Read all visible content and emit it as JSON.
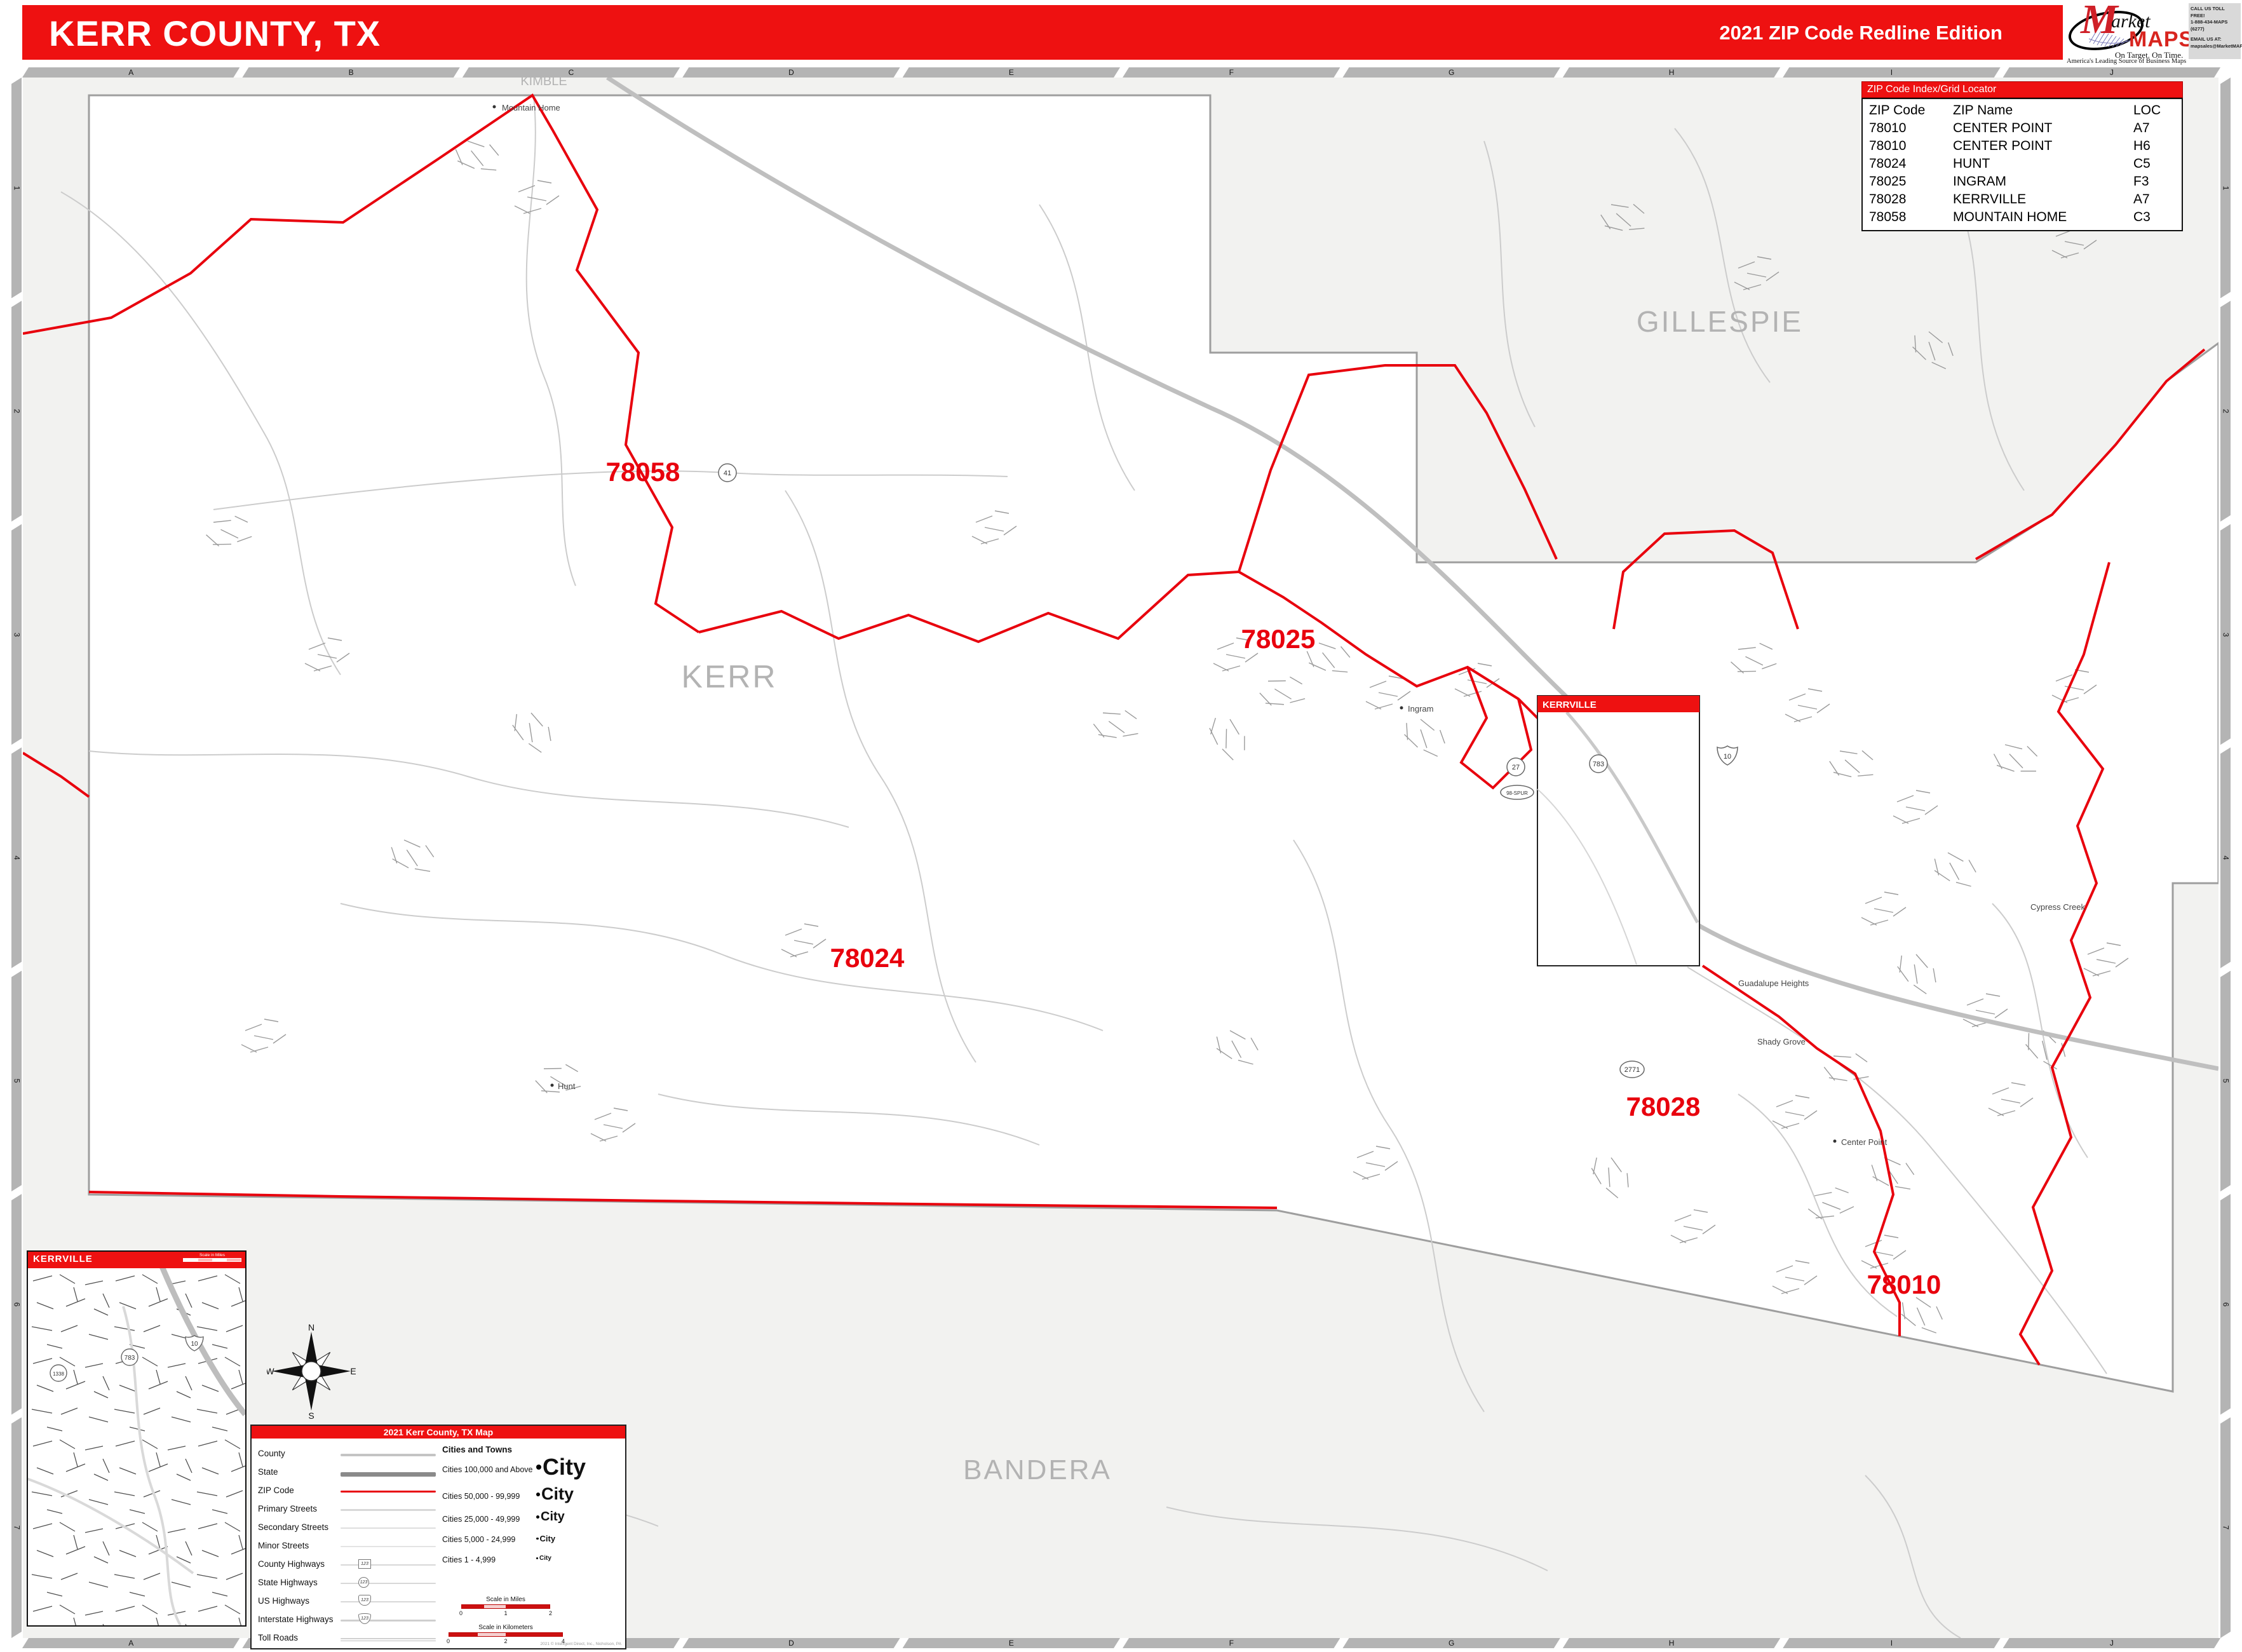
{
  "header": {
    "title": "KERR COUNTY, TX",
    "edition": "2021 ZIP Code Redline Edition"
  },
  "logo": {
    "m": "M",
    "arket": "arket",
    "maps": "MAPS",
    "tagline": "On Target.  On Time.",
    "subtitle": "America's Leading Source of Business Maps",
    "contact_lines": [
      "CALL US TOLL FREE!",
      "1-888-434-MAPS (6277)",
      "EMAIL US AT:",
      "mapsales@MarketMAPS.com"
    ]
  },
  "index_table": {
    "title": "ZIP Code Index/Grid Locator",
    "columns": [
      "ZIP Code",
      "ZIP Name",
      "LOC"
    ],
    "rows": [
      [
        "78010",
        "CENTER POINT",
        "A7"
      ],
      [
        "78010",
        "CENTER POINT",
        "H6"
      ],
      [
        "78024",
        "HUNT",
        "C5"
      ],
      [
        "78025",
        "INGRAM",
        "F3"
      ],
      [
        "78028",
        "KERRVILLE",
        "A7"
      ],
      [
        "78058",
        "MOUNTAIN HOME",
        "C3"
      ]
    ]
  },
  "grid": {
    "columns": [
      "A",
      "B",
      "C",
      "D",
      "E",
      "F",
      "G",
      "H",
      "I",
      "J"
    ],
    "rows": [
      "1",
      "2",
      "3",
      "4",
      "5",
      "6",
      "7"
    ]
  },
  "map": {
    "county_labels": {
      "kerr": "KERR",
      "gillespie": "GILLESPIE",
      "bandera": "BANDERA",
      "kimble": "KIMBLE"
    },
    "zip_labels": [
      {
        "code": "78058"
      },
      {
        "code": "78025"
      },
      {
        "code": "78024"
      },
      {
        "code": "78028"
      },
      {
        "code": "78010"
      }
    ],
    "towns": {
      "mountain_home": "Mountain Home",
      "hunt": "Hunt",
      "ingram": "Ingram",
      "center_point": "Center Point",
      "guadalupe_heights": "Guadalupe Heights",
      "shady_grove": "Shady Grove",
      "cypress_creek": "Cypress Creek"
    },
    "shields": {
      "s41": "41",
      "s27": "27",
      "s783": "783",
      "s2771": "2771",
      "i10": "10",
      "spur": "98-SPUR",
      "s1338": "1338"
    },
    "inset_marker_title": "KERRVILLE"
  },
  "inset": {
    "title": "KERRVILLE",
    "scale_label": "Scale in Miles"
  },
  "legend": {
    "title": "2021 Kerr County, TX Map",
    "line_items": [
      "County",
      "State",
      "ZIP Code",
      "Primary Streets",
      "Secondary Streets",
      "Minor Streets",
      "County Highways",
      "State Highways",
      "US Highways",
      "Interstate Highways",
      "Toll Roads"
    ],
    "shield_sample": "123",
    "cities_header": "Cities and Towns",
    "city_classes": [
      {
        "label": "Cities 100,000 and Above",
        "sample": "City"
      },
      {
        "label": "Cities 50,000 - 99,999",
        "sample": "City"
      },
      {
        "label": "Cities 25,000 - 49,999",
        "sample": "City"
      },
      {
        "label": "Cities 5,000 - 24,999",
        "sample": "City"
      },
      {
        "label": "Cities 1 - 4,999",
        "sample": "City"
      }
    ],
    "scale_miles": {
      "label": "Scale in Miles",
      "ticks": [
        "0",
        "1",
        "2"
      ]
    },
    "scale_km": {
      "label": "Scale in Kilometers",
      "ticks": [
        "0",
        "2",
        "4"
      ]
    },
    "copyright": "2021 © Intelligent Direct, Inc., Nicholson, PA"
  },
  "compass": {
    "n": "N",
    "e": "E",
    "s": "S",
    "w": "W"
  }
}
